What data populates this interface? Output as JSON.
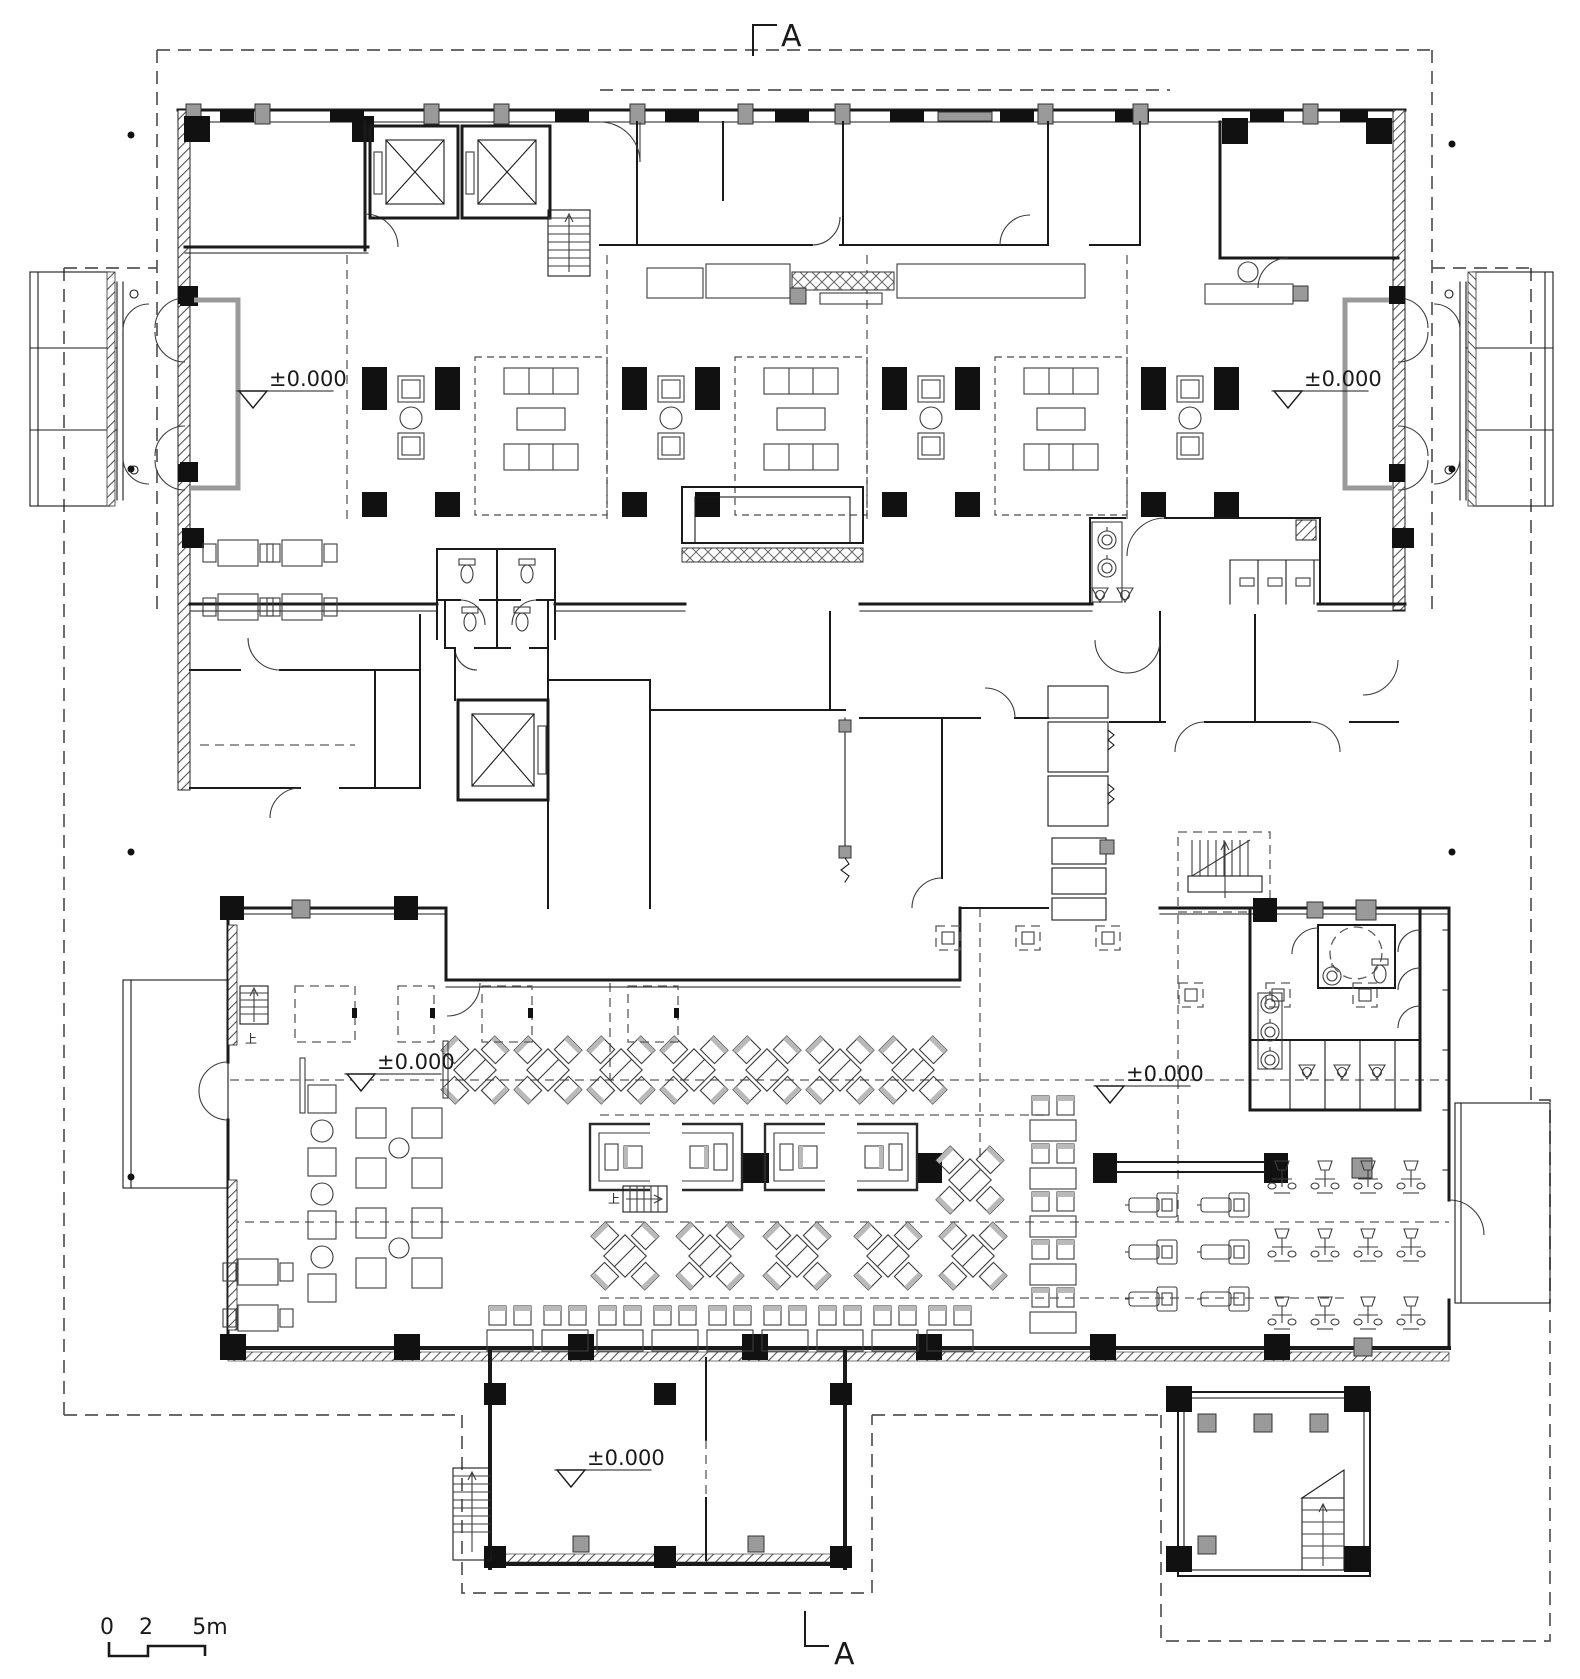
{
  "meta": {
    "drawing_type": "architectural floor plan",
    "level": "ground floor"
  },
  "section_markers": {
    "top": "A",
    "bottom": "A"
  },
  "level_markers": {
    "lobby_left": "±0.000",
    "lobby_right": "±0.000",
    "dining_left": "±0.000",
    "dining_right": "±0.000",
    "entrance": "±0.000"
  },
  "stair_labels": {
    "west": "上",
    "center": "上"
  },
  "scale_bar": {
    "tick_0": "0",
    "tick_2": "2",
    "tick_5": "5m"
  },
  "colors": {
    "ink": "#1a1a1a",
    "column_fill": "#111111",
    "gray_fill": "#9a9a9a",
    "dashed": "#5a5a5a",
    "background": "#ffffff"
  }
}
